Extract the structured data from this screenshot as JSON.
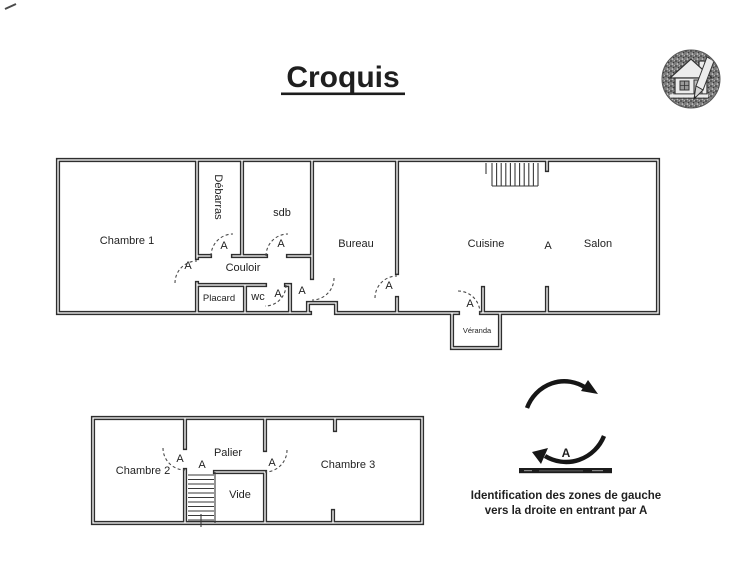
{
  "page": {
    "title": "Croquis",
    "background": "#ffffff",
    "ink": "#2e2e2e"
  },
  "stamp": {
    "icon": "house-pencil-stamp-icon"
  },
  "marker": "A",
  "ground_floor": {
    "rooms": {
      "chambre1": "Chambre 1",
      "debarras": "Débarras",
      "sdb": "sdb",
      "couloir": "Couloir",
      "placard": "Placard",
      "wc": "wc",
      "bureau": "Bureau",
      "cuisine": "Cuisine",
      "salon": "Salon",
      "veranda": "Véranda"
    }
  },
  "upper_floor": {
    "rooms": {
      "chambre2": "Chambre 2",
      "palier": "Palier",
      "vide": "Vide",
      "chambre3": "Chambre 3"
    }
  },
  "legend": {
    "caption_line1": "Identification des zones de gauche",
    "caption_line2": "vers la droite en entrant par A"
  }
}
